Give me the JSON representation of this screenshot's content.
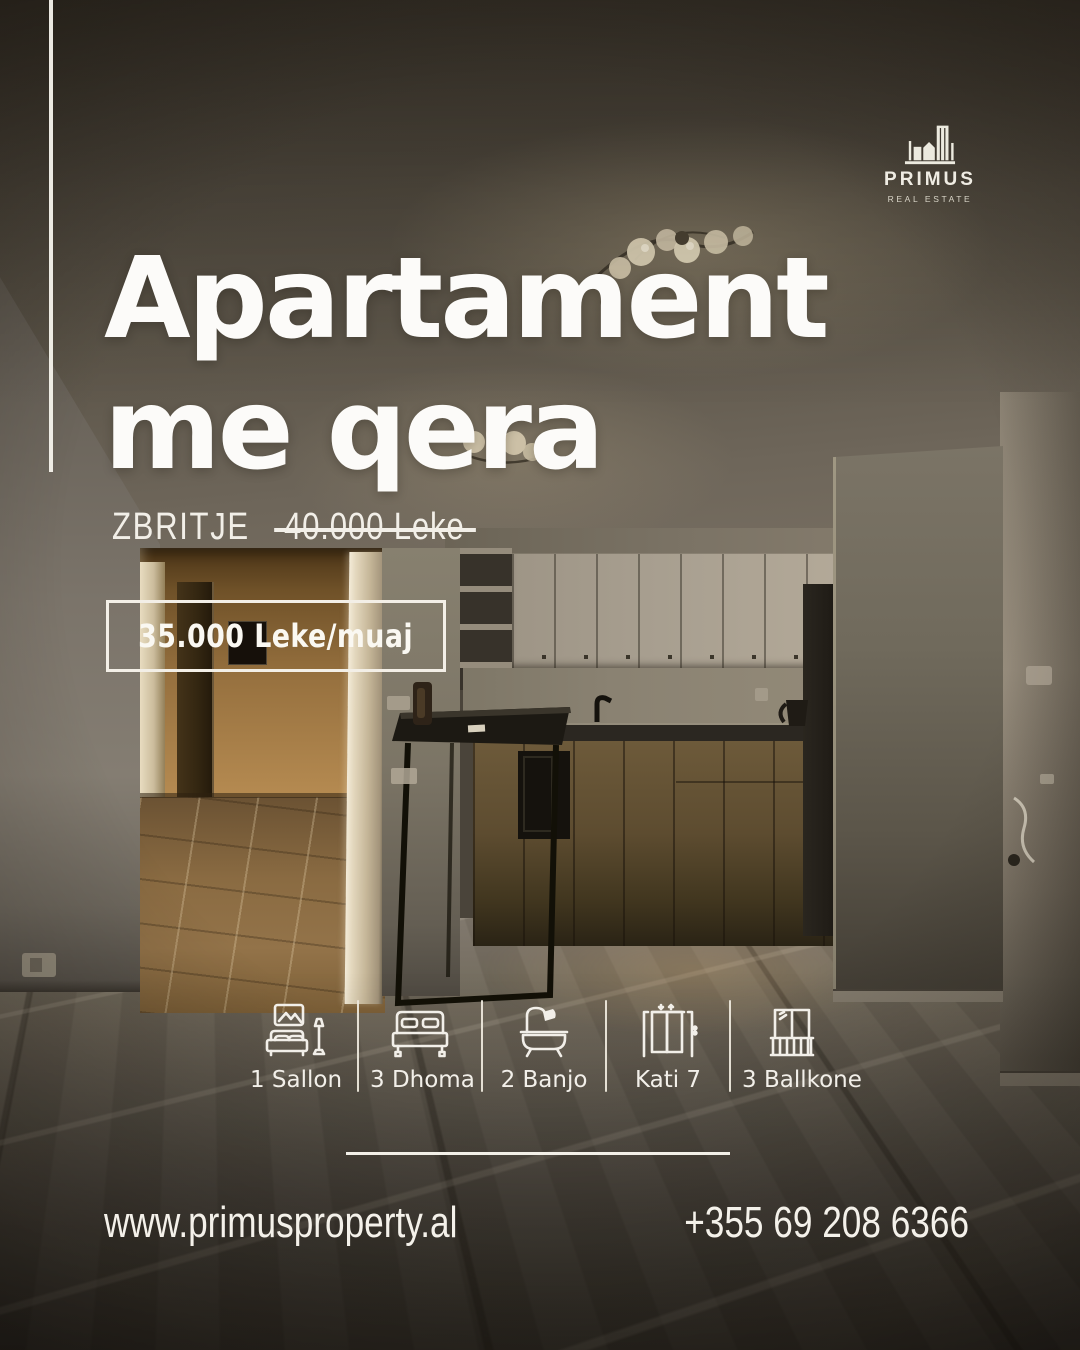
{
  "brand": {
    "name": "PRIMUS",
    "tagline": "REAL ESTATE"
  },
  "title": {
    "line1": "Apartament",
    "line2": "me qera"
  },
  "discount": {
    "label": "ZBRITJE",
    "old_price": "40.000 Leke"
  },
  "price": {
    "value": "35.000 Leke/muaj"
  },
  "features": [
    {
      "icon": "sofa-icon",
      "label": "1 Sallon"
    },
    {
      "icon": "bed-icon",
      "label": "3 Dhoma"
    },
    {
      "icon": "bathtub-icon",
      "label": "2 Banjo"
    },
    {
      "icon": "elevator-icon",
      "label": "Kati 7"
    },
    {
      "icon": "balcony-icon",
      "label": "3 Ballkone"
    }
  ],
  "contact": {
    "website": "www.primusproperty.al",
    "phone": "+355 69 208 6366"
  },
  "colors": {
    "accent_white": "#F5F2EA",
    "hallway_warm": "#B78C52",
    "photo_base": "#4A443A"
  }
}
